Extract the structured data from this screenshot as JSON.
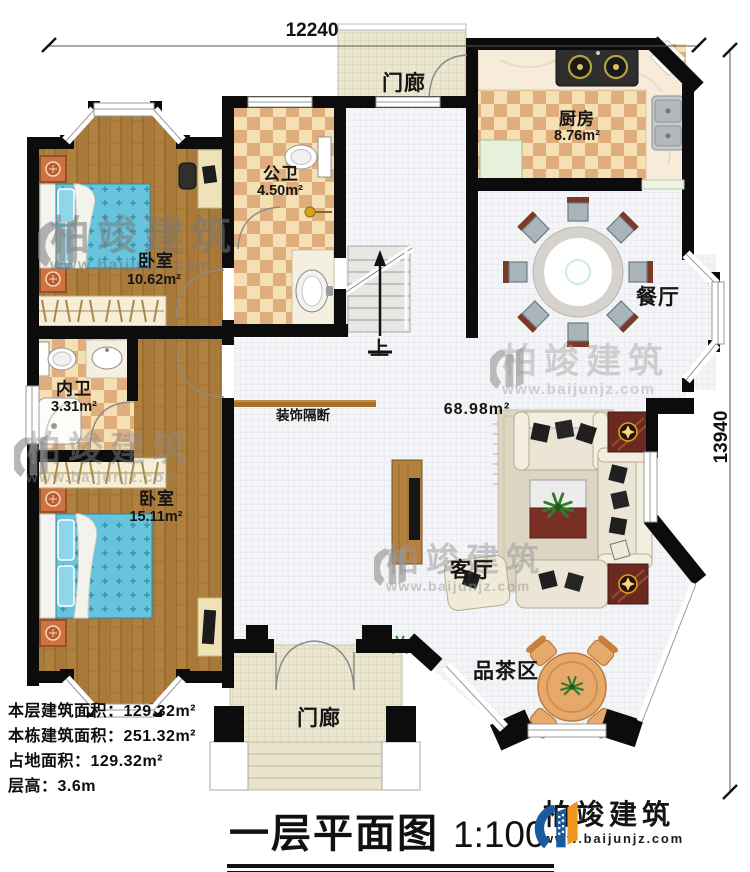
{
  "title_block": {
    "title": "一层平面图",
    "scale": "1:100"
  },
  "dimensions": {
    "top_width": "12240",
    "right_height": "13940"
  },
  "rooms": {
    "porch_top": {
      "label": "门廊"
    },
    "kitchen": {
      "label": "厨房",
      "area": "8.76m²"
    },
    "public_bath": {
      "label": "公卫",
      "area": "4.50m²"
    },
    "bedroom_top": {
      "label": "卧室",
      "area": "10.62m²"
    },
    "dining": {
      "label": "餐厅"
    },
    "inner_bath": {
      "label": "内卫",
      "area": "3.31m²"
    },
    "bedroom_bottom": {
      "label": "卧室",
      "area": "15.11m²"
    },
    "living": {
      "label": "客厅"
    },
    "tea_area": {
      "label": "品茶区"
    },
    "porch_bottom": {
      "label": "门廊"
    }
  },
  "annotations": {
    "hall_area": "68.98m²",
    "partition": "装饰隔断",
    "stairs_up": "上"
  },
  "info_block": {
    "lines": [
      "本层建筑面积：129.32m²",
      "本栋建筑面积：251.32m²",
      "占地面积：129.32m²",
      "层高：3.6m"
    ]
  },
  "brand": {
    "name": "柏竣建筑",
    "url": "www.baijunjz.com"
  },
  "watermark": {
    "name": "柏竣建筑",
    "url": "www.baijunjz.com"
  },
  "colors": {
    "wall": "#0c0c0c",
    "wood_floor": "#b0803e",
    "tile_light": "#f5e0b4",
    "tile_dark": "#e0ae7c",
    "hall_floor": "#f4f5f7",
    "porch_floor": "#eae6d0",
    "bed_blue": "#68c3dc",
    "sofa_cream": "#ebe5d5",
    "accent_wood_dark": "#6b2a1f",
    "gold": "#d9a21a",
    "logo_blue": "#1b5aa0",
    "logo_orange": "#f2971d"
  }
}
